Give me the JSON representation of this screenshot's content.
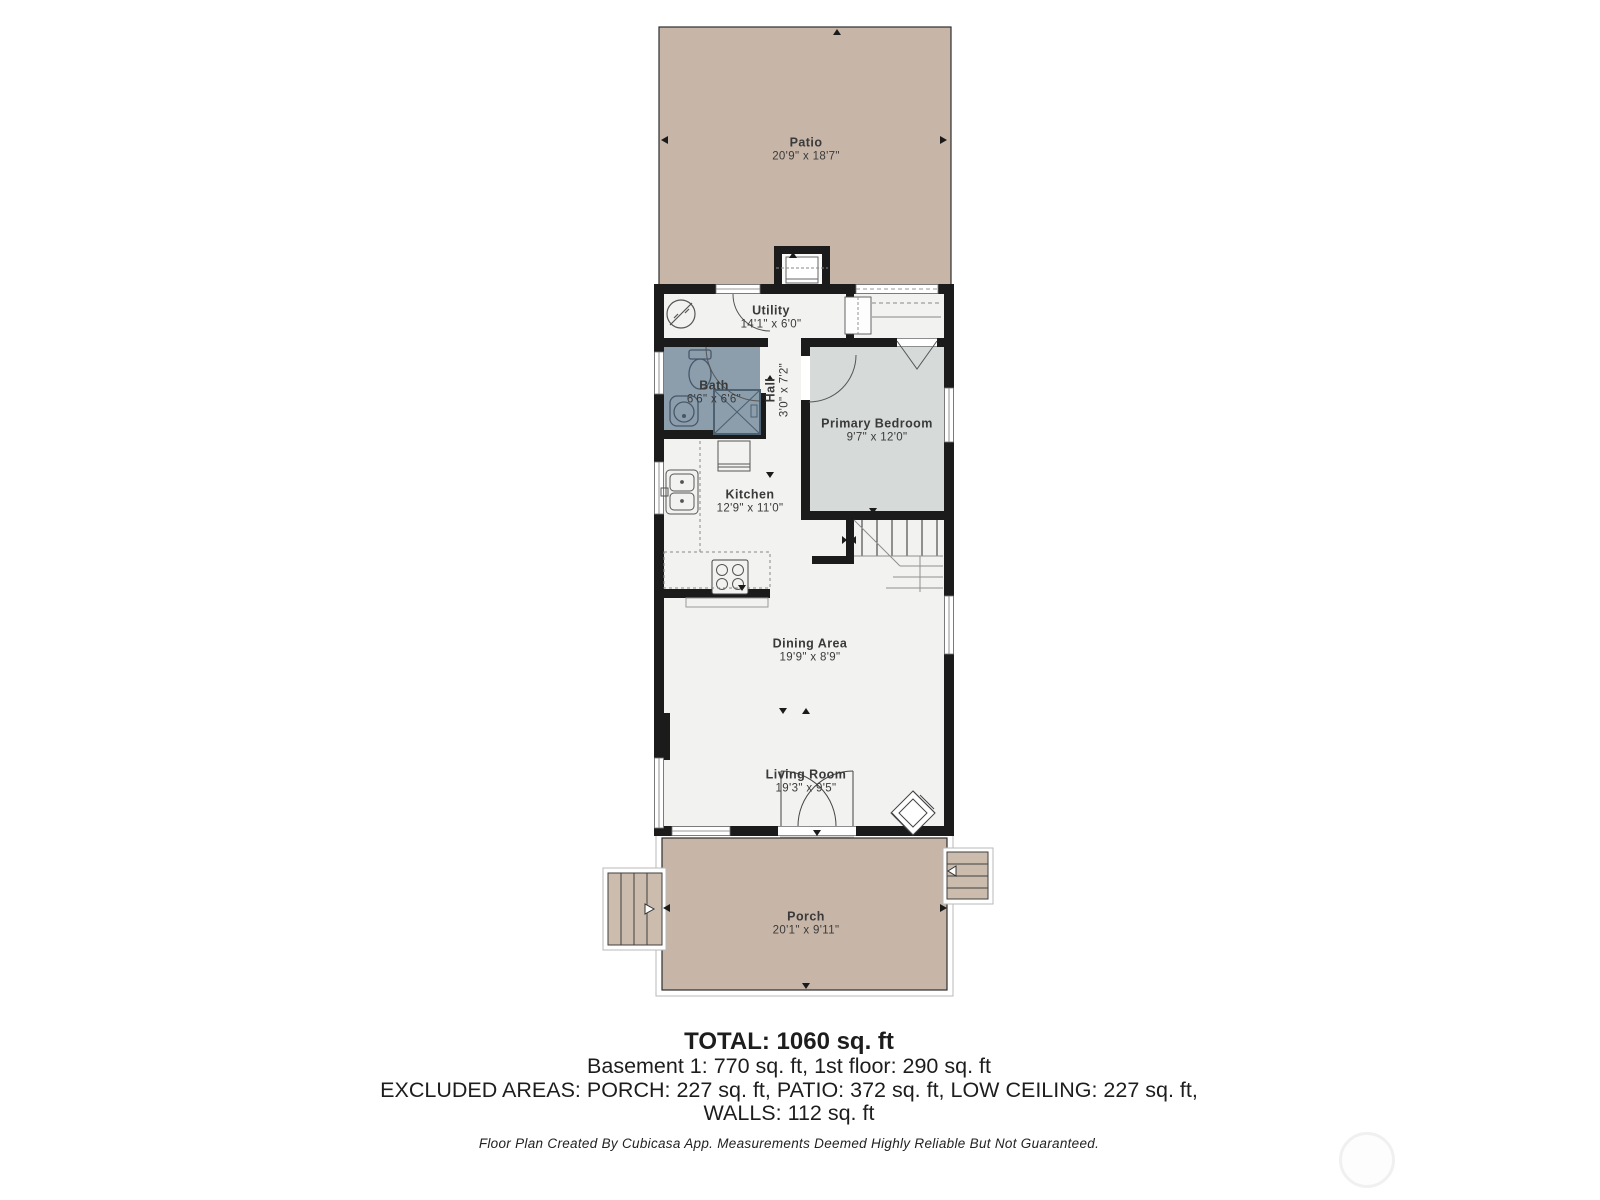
{
  "plan": {
    "rooms": [
      {
        "name": "Patio",
        "dims": "20'9\" x 18'7\""
      },
      {
        "name": "Utility",
        "dims": "14'1\" x 6'0\""
      },
      {
        "name": "Bath",
        "dims": "6'6\" x 6'6\""
      },
      {
        "name": "Hall",
        "dims": "3'0\" x 7'2\""
      },
      {
        "name": "Primary Bedroom",
        "dims": "9'7\" x 12'0\""
      },
      {
        "name": "Kitchen",
        "dims": "12'9\" x 11'0\""
      },
      {
        "name": "Dining Area",
        "dims": "19'9\" x 8'9\""
      },
      {
        "name": "Living Room",
        "dims": "19'3\" x 9'5\""
      },
      {
        "name": "Porch",
        "dims": "20'1\" x 9'11\""
      }
    ]
  },
  "summary": {
    "total": "TOTAL: 1060 sq. ft",
    "floors": "Basement 1: 770 sq. ft, 1st floor: 290 sq. ft",
    "excluded_line1": "EXCLUDED AREAS: PORCH: 227 sq. ft, PATIO: 372 sq. ft, LOW CEILING: 227 sq. ft,",
    "excluded_line2": "WALLS: 112 sq. ft",
    "disclaimer": "Floor Plan Created By Cubicasa App. Measurements Deemed Highly Reliable But Not Guaranteed."
  },
  "colors": {
    "outdoor_tan": "#c7b6a8",
    "stairs_tan": "#cbbcae",
    "floor": "#f2f3f1",
    "bath_blue_gray": "#8c9eac",
    "bedroom_gray": "#d6dad9",
    "wall_black": "#1b1b1b"
  }
}
